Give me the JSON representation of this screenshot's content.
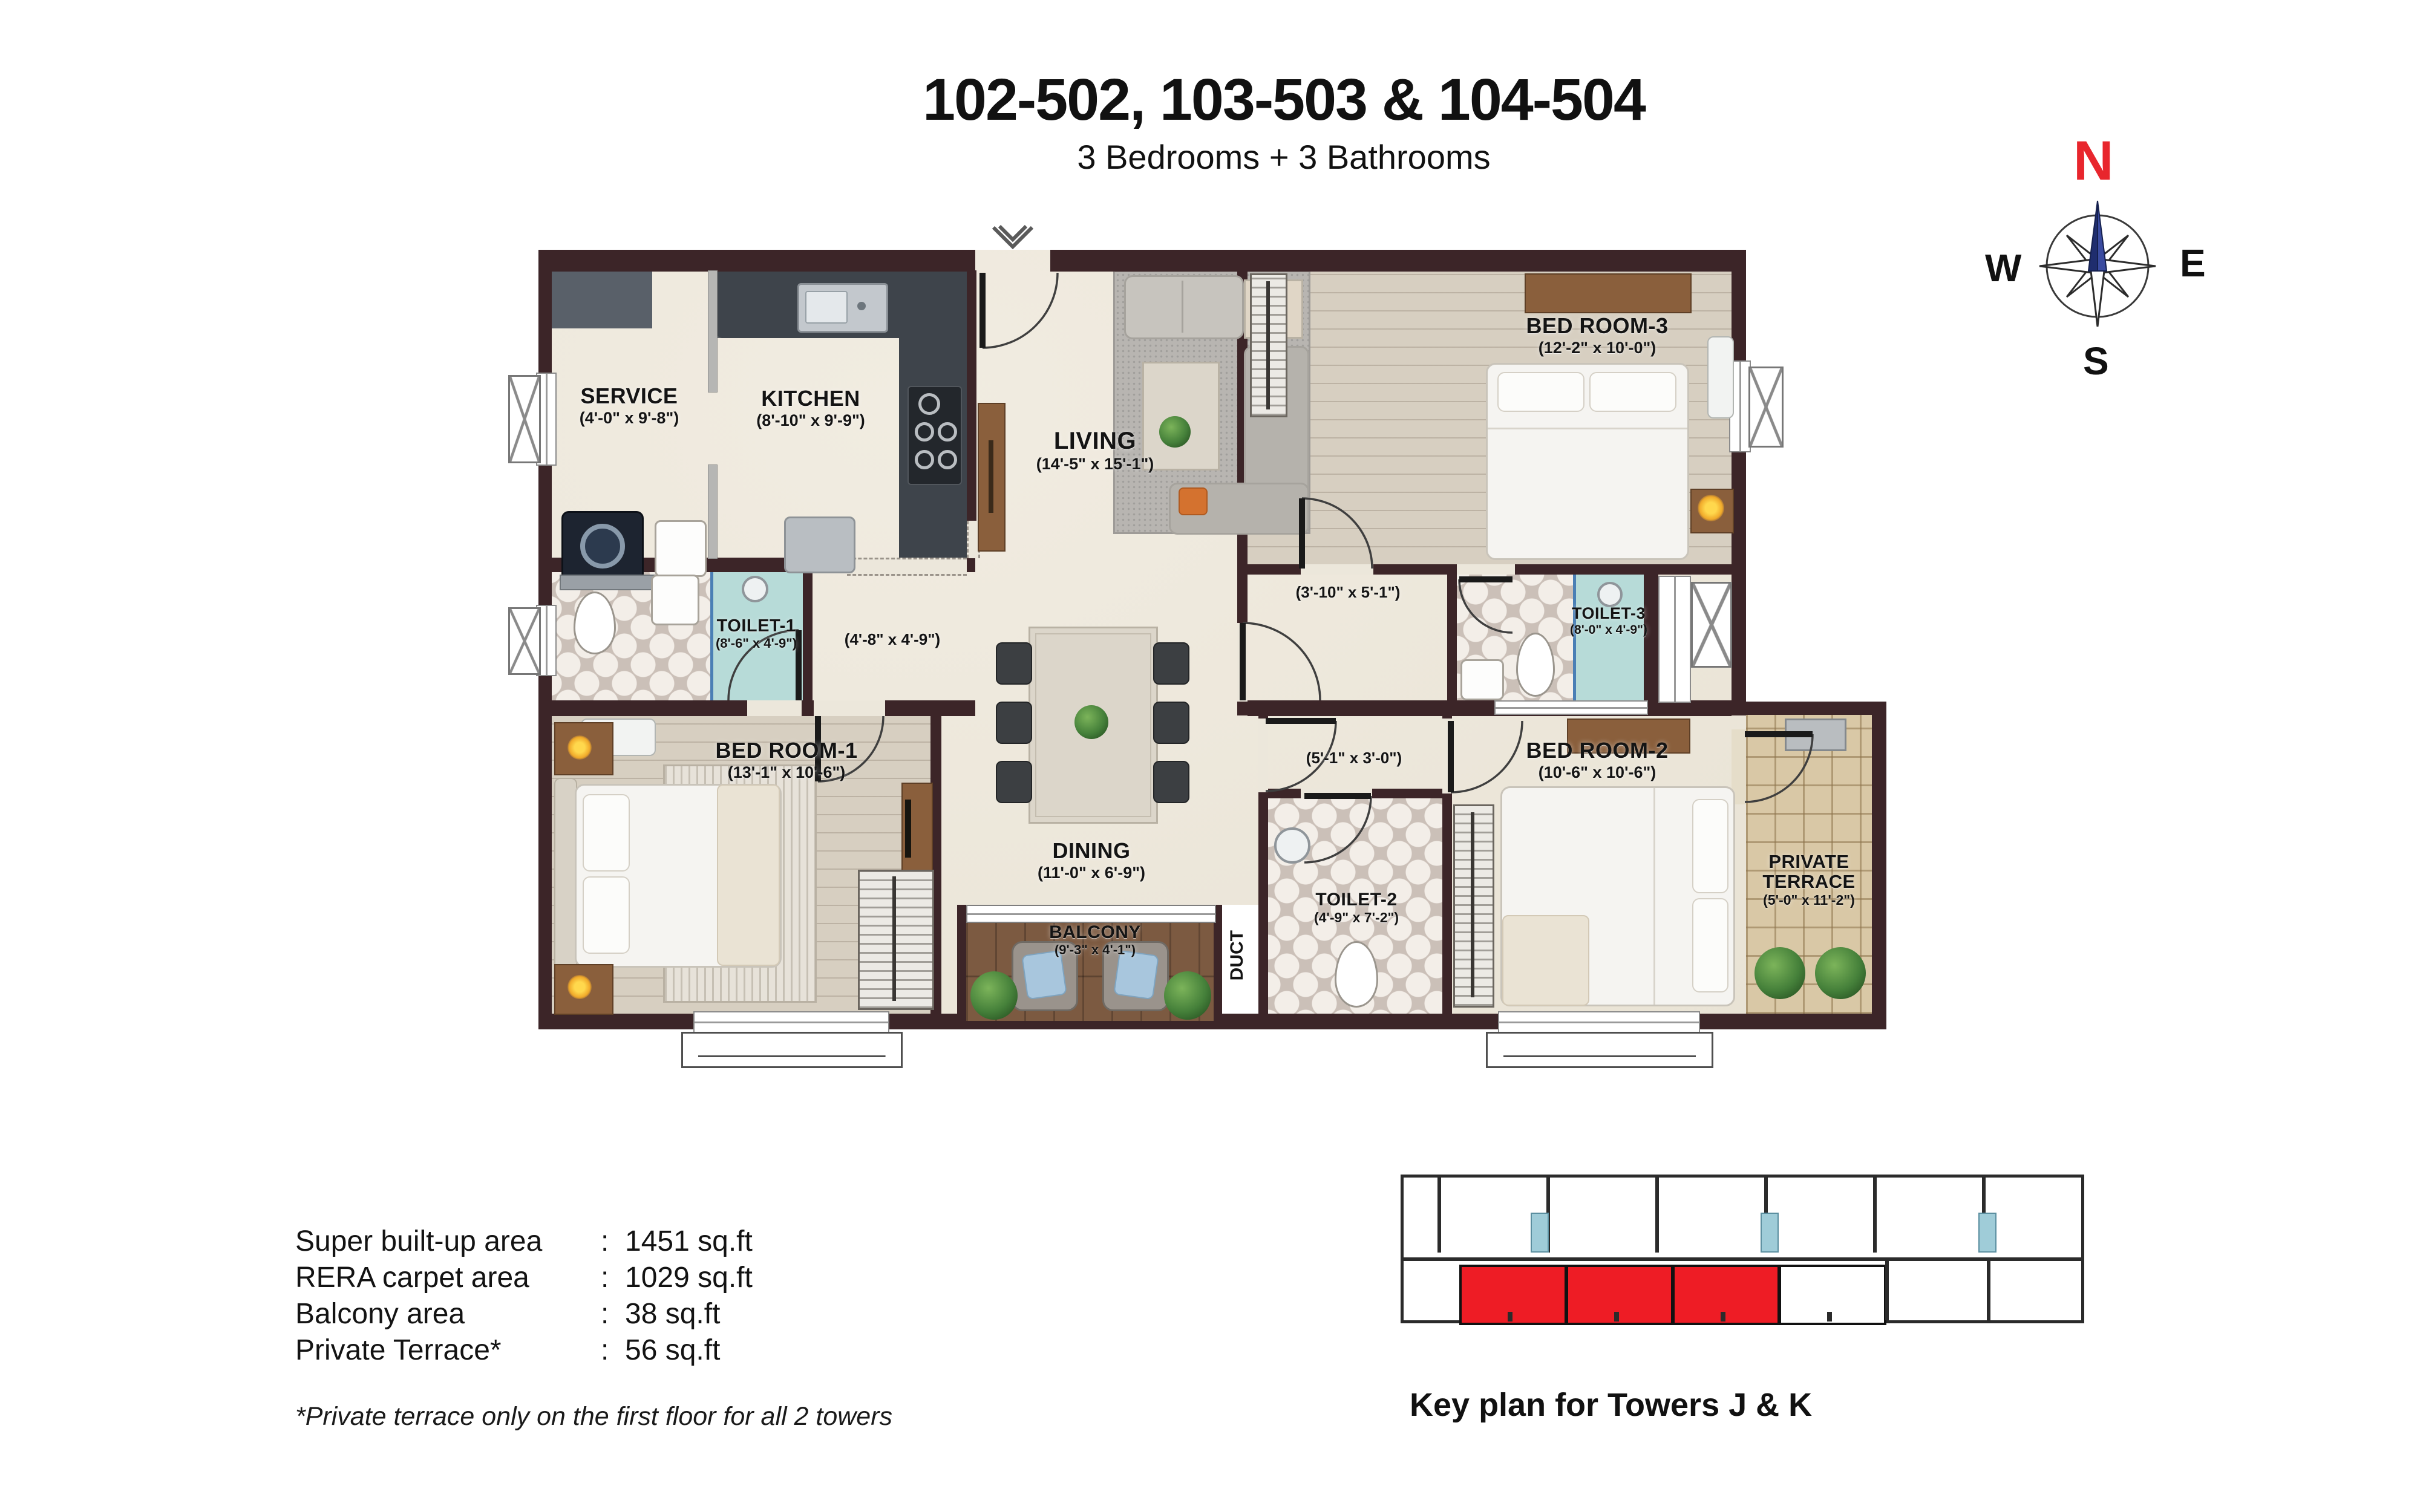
{
  "header": {
    "title": "102-502, 103-503 & 104-504",
    "subtitle": "3 Bedrooms + 3 Bathrooms"
  },
  "compass": {
    "north": "N",
    "east": "E",
    "south": "S",
    "west": "W"
  },
  "rooms": {
    "service": {
      "name": "SERVICE",
      "dim": "(4'-0\" x 9'-8\")"
    },
    "kitchen": {
      "name": "KITCHEN",
      "dim": "(8'-10\" x 9'-9\")"
    },
    "living": {
      "name": "LIVING",
      "dim": "(14'-5\" x 15'-1\")"
    },
    "bedroom3": {
      "name": "BED ROOM-3",
      "dim": "(12'-2\" x 10'-0\")"
    },
    "toilet1": {
      "name": "TOILET-1",
      "dim": "(8'-6\" x 4'-9\")"
    },
    "passage": {
      "dim": "(4'-8\" x 4'-9\")"
    },
    "vestibule": {
      "dim": "(3'-10\" x 5'-1\")"
    },
    "toilet3": {
      "name": "TOILET-3",
      "dim": "(8'-0\" x 4'-9\")"
    },
    "bedroom1": {
      "name": "BED ROOM-1",
      "dim": "(13'-1\" x 10'-6\")"
    },
    "lobby": {
      "dim": "(5'-1\" x 3'-0\")"
    },
    "bedroom2": {
      "name": "BED ROOM-2",
      "dim": "(10'-6\" x 10'-6\")"
    },
    "toilet2": {
      "name": "TOILET-2",
      "dim": "(4'-9\" x 7'-2\")"
    },
    "dining": {
      "name": "DINING",
      "dim": "(11'-0\" x 6'-9\")"
    },
    "balcony": {
      "name": "BALCONY",
      "dim": "(9'-3\" x 4'-1\")"
    },
    "duct": {
      "name": "DUCT"
    },
    "terrace": {
      "name": "PRIVATE TERRACE",
      "dim": "(5'-0\" x 11'-2\")"
    }
  },
  "areas": {
    "rows": [
      {
        "label": "Super built-up area",
        "sep": ":",
        "value": "1451 sq.ft"
      },
      {
        "label": "RERA carpet area",
        "sep": ":",
        "value": "1029 sq.ft"
      },
      {
        "label": "Balcony area",
        "sep": ":",
        "value": "38 sq.ft"
      },
      {
        "label": "Private Terrace*",
        "sep": ":",
        "value": "56 sq.ft"
      }
    ],
    "footnote": "*Private terrace only on the first floor for all 2 towers"
  },
  "keyplan": {
    "caption": "Key plan for Towers J & K",
    "highlight_color": "#ee1c25"
  },
  "colors": {
    "wall": "#3c2528",
    "toilet_teal": "#b7dbd8",
    "keyplan_highlight": "#ee1c25",
    "compass_north": "#e8262d",
    "needle_blue": "#2e4093"
  }
}
